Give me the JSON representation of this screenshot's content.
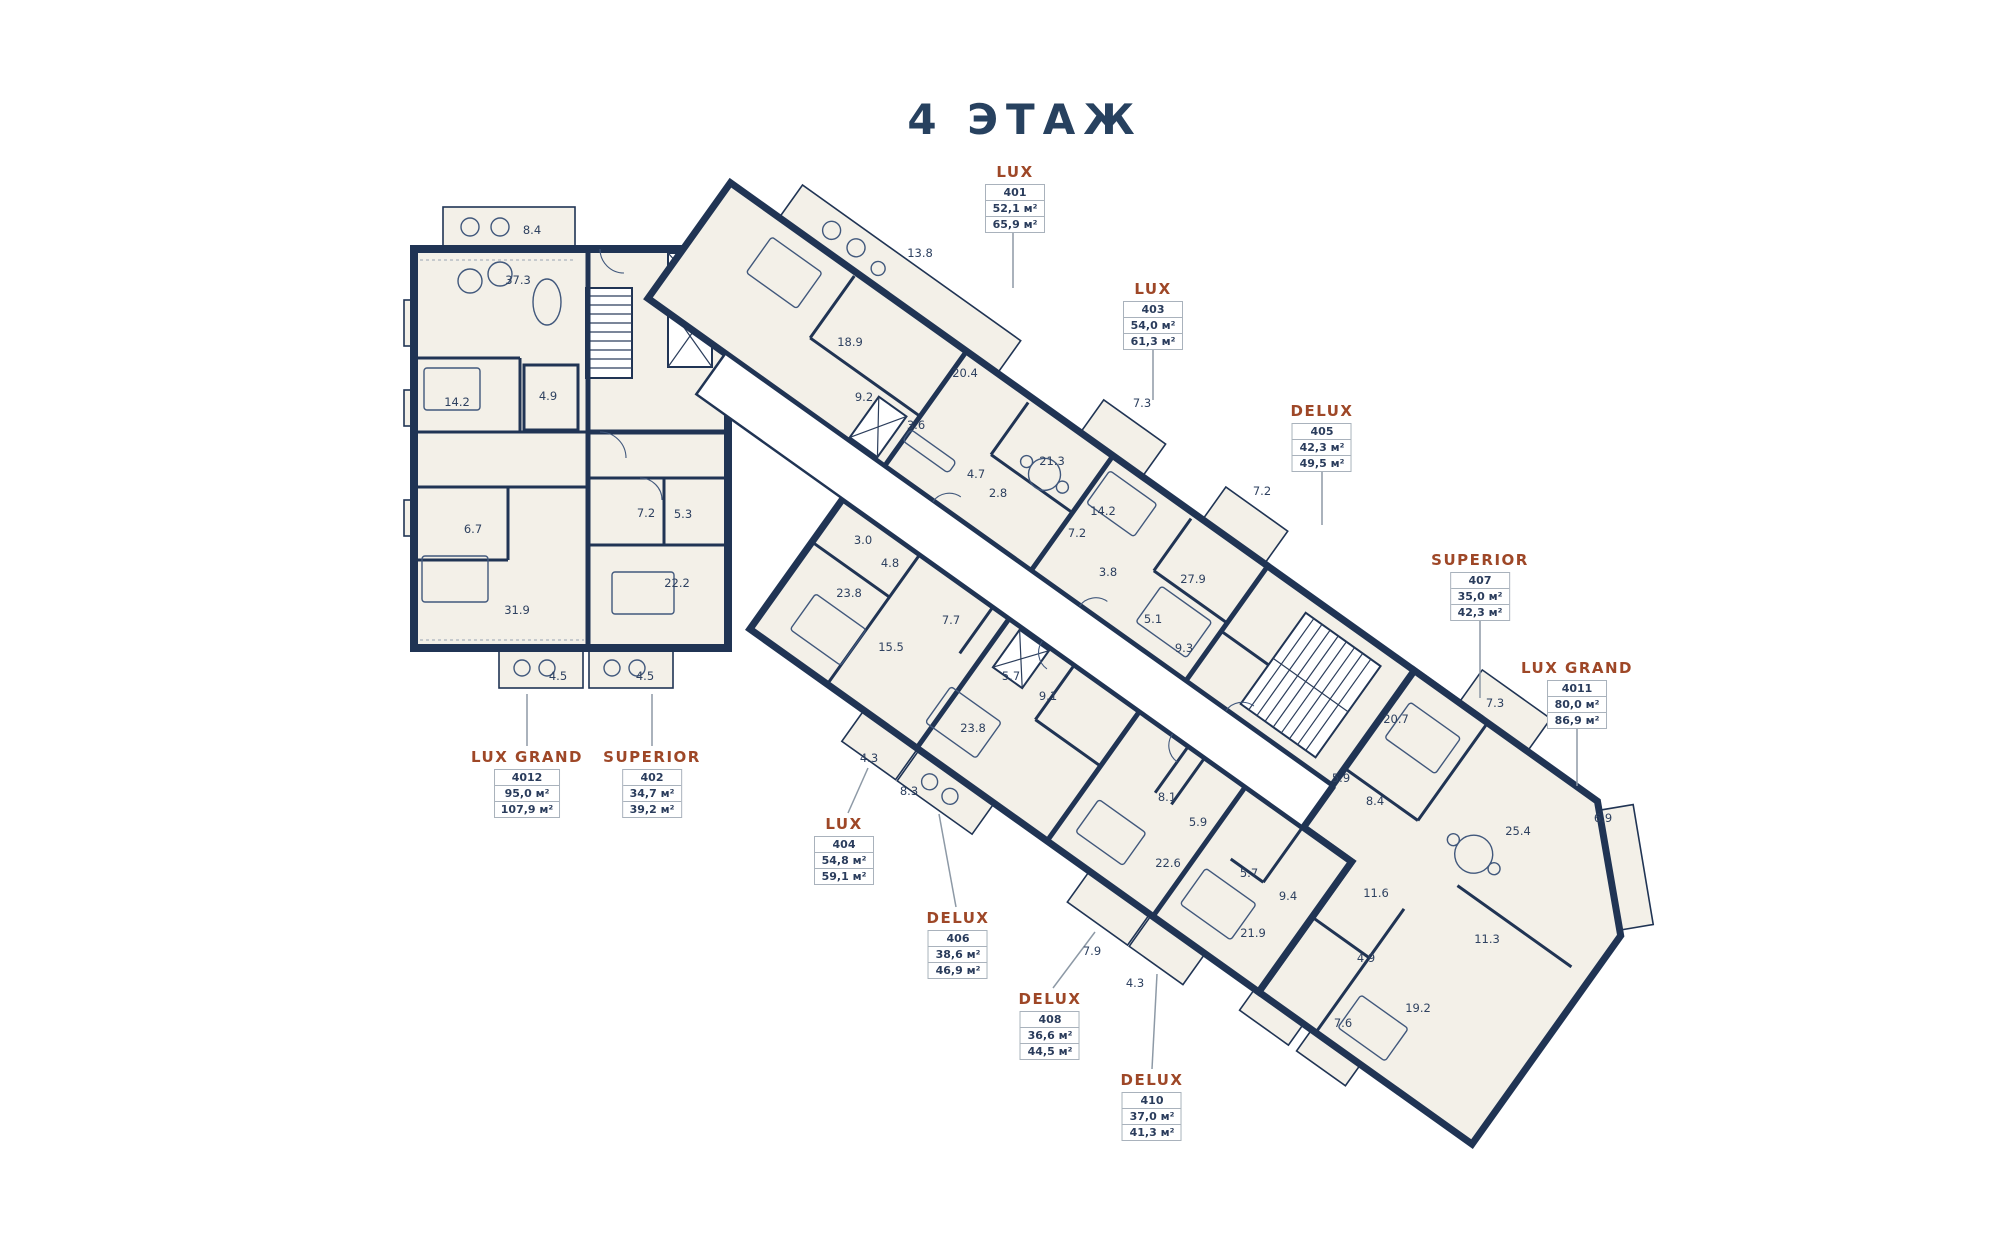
{
  "title": "4 ЭТАЖ",
  "colors": {
    "navy": "#203454",
    "rust": "#9e4727",
    "room_fill": "#f3f0e8",
    "label_text": "#2e4160",
    "box_border": "#a9b2bc"
  },
  "units": [
    {
      "type": "LUX",
      "number": "401",
      "area_living": "52,1 м²",
      "area_total": "65,9 м²",
      "x": 1015,
      "y": 163,
      "leader": "M1013,226 L1013,288"
    },
    {
      "type": "LUX",
      "number": "403",
      "area_living": "54,0 м²",
      "area_total": "61,3 м²",
      "x": 1153,
      "y": 280,
      "leader": "M1153,343 L1153,400"
    },
    {
      "type": "DELUX",
      "number": "405",
      "area_living": "42,3 м²",
      "area_total": "49,5 м²",
      "x": 1322,
      "y": 402,
      "leader": "M1322,465 L1322,525"
    },
    {
      "type": "SUPERIOR",
      "number": "407",
      "area_living": "35,0 м²",
      "area_total": "42,3 м²",
      "x": 1480,
      "y": 551,
      "leader": "M1480,614 L1480,698"
    },
    {
      "type": "LUX GRAND",
      "number": "4011",
      "area_living": "80,0 м²",
      "area_total": "86,9 м²",
      "x": 1577,
      "y": 659,
      "leader": "M1577,722 L1577,786"
    },
    {
      "type": "LUX GRAND",
      "number": "4012",
      "area_living": "95,0 м²",
      "area_total": "107,9 м²",
      "x": 527,
      "y": 748,
      "leader": "M527,746 L527,694"
    },
    {
      "type": "SUPERIOR",
      "number": "402",
      "area_living": "34,7 м²",
      "area_total": "39,2 м²",
      "x": 652,
      "y": 748,
      "leader": "M652,746 L652,694"
    },
    {
      "type": "LUX",
      "number": "404",
      "area_living": "54,8 м²",
      "area_total": "59,1 м²",
      "x": 844,
      "y": 815,
      "leader": "M848,813 L868,768"
    },
    {
      "type": "DELUX",
      "number": "406",
      "area_living": "38,6 м²",
      "area_total": "46,9 м²",
      "x": 958,
      "y": 909,
      "leader": "M956,907 L939,814"
    },
    {
      "type": "DELUX",
      "number": "408",
      "area_living": "36,6 м²",
      "area_total": "44,5 м²",
      "x": 1050,
      "y": 990,
      "leader": "M1053,988 L1095,932"
    },
    {
      "type": "DELUX",
      "number": "410",
      "area_living": "37,0 м²",
      "area_total": "41,3 м²",
      "x": 1152,
      "y": 1071,
      "leader": "M1152,1069 L1157,974"
    }
  ],
  "rooms": [
    {
      "a": "8.4",
      "x": 532,
      "y": 230
    },
    {
      "a": "37.3",
      "x": 518,
      "y": 280
    },
    {
      "a": "14.2",
      "x": 457,
      "y": 402
    },
    {
      "a": "4.9",
      "x": 548,
      "y": 396
    },
    {
      "a": "6.7",
      "x": 473,
      "y": 529
    },
    {
      "a": "31.9",
      "x": 517,
      "y": 610
    },
    {
      "a": "7.2",
      "x": 646,
      "y": 513
    },
    {
      "a": "5.3",
      "x": 683,
      "y": 514
    },
    {
      "a": "22.2",
      "x": 677,
      "y": 583
    },
    {
      "a": "4.5",
      "x": 558,
      "y": 676
    },
    {
      "a": "4.5",
      "x": 645,
      "y": 676
    },
    {
      "a": "13.8",
      "x": 920,
      "y": 253
    },
    {
      "a": "18.9",
      "x": 850,
      "y": 342
    },
    {
      "a": "20.4",
      "x": 965,
      "y": 373
    },
    {
      "a": "9.2",
      "x": 864,
      "y": 397
    },
    {
      "a": "3.6",
      "x": 916,
      "y": 425
    },
    {
      "a": "7.3",
      "x": 1142,
      "y": 403
    },
    {
      "a": "21.3",
      "x": 1052,
      "y": 461
    },
    {
      "a": "4.7",
      "x": 976,
      "y": 474
    },
    {
      "a": "2.8",
      "x": 998,
      "y": 493
    },
    {
      "a": "14.2",
      "x": 1103,
      "y": 511
    },
    {
      "a": "7.2",
      "x": 1077,
      "y": 533
    },
    {
      "a": "7.2",
      "x": 1262,
      "y": 491
    },
    {
      "a": "3.8",
      "x": 1108,
      "y": 572
    },
    {
      "a": "27.9",
      "x": 1193,
      "y": 579
    },
    {
      "a": "5.1",
      "x": 1153,
      "y": 619
    },
    {
      "a": "9.3",
      "x": 1184,
      "y": 648
    },
    {
      "a": "3.0",
      "x": 863,
      "y": 540
    },
    {
      "a": "4.8",
      "x": 890,
      "y": 563
    },
    {
      "a": "23.8",
      "x": 849,
      "y": 593
    },
    {
      "a": "7.7",
      "x": 951,
      "y": 620
    },
    {
      "a": "15.5",
      "x": 891,
      "y": 647
    },
    {
      "a": "5.7",
      "x": 1011,
      "y": 676
    },
    {
      "a": "9.1",
      "x": 1048,
      "y": 696
    },
    {
      "a": "23.8",
      "x": 973,
      "y": 728
    },
    {
      "a": "4.3",
      "x": 869,
      "y": 758
    },
    {
      "a": "8.3",
      "x": 909,
      "y": 791
    },
    {
      "a": "8.1",
      "x": 1167,
      "y": 797
    },
    {
      "a": "5.9",
      "x": 1198,
      "y": 822
    },
    {
      "a": "22.6",
      "x": 1168,
      "y": 863
    },
    {
      "a": "5.7",
      "x": 1249,
      "y": 873
    },
    {
      "a": "9.4",
      "x": 1288,
      "y": 896
    },
    {
      "a": "21.9",
      "x": 1253,
      "y": 933
    },
    {
      "a": "7.9",
      "x": 1092,
      "y": 951
    },
    {
      "a": "4.3",
      "x": 1135,
      "y": 983
    },
    {
      "a": "5.9",
      "x": 1341,
      "y": 778
    },
    {
      "a": "8.4",
      "x": 1375,
      "y": 801
    },
    {
      "a": "11.6",
      "x": 1376,
      "y": 893
    },
    {
      "a": "4.9",
      "x": 1366,
      "y": 958
    },
    {
      "a": "7.6",
      "x": 1343,
      "y": 1023
    },
    {
      "a": "19.2",
      "x": 1418,
      "y": 1008
    },
    {
      "a": "11.3",
      "x": 1487,
      "y": 939
    },
    {
      "a": "20.7",
      "x": 1396,
      "y": 719
    },
    {
      "a": "7.3",
      "x": 1495,
      "y": 703
    },
    {
      "a": "25.4",
      "x": 1518,
      "y": 831
    },
    {
      "a": "6.9",
      "x": 1603,
      "y": 818
    }
  ]
}
